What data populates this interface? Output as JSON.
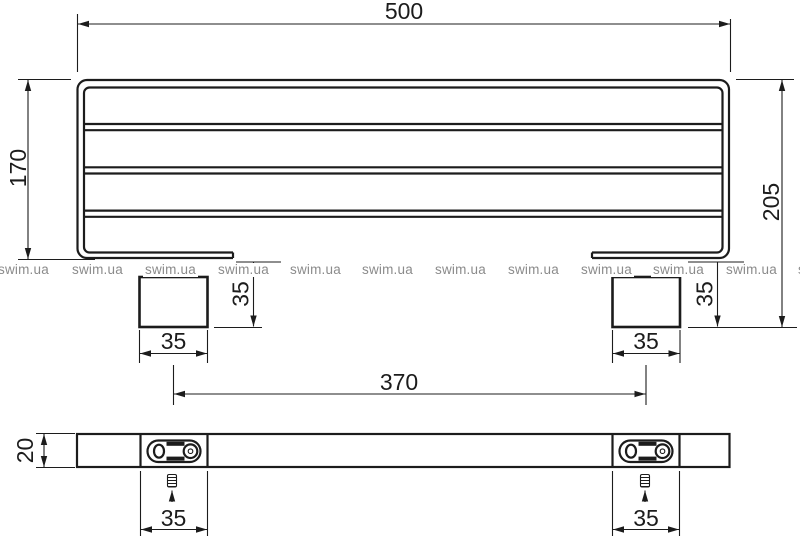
{
  "front_view": {
    "overall_width": "500",
    "frame_height": "170",
    "overall_height": "205",
    "left_bracket_width": "35",
    "right_bracket_width": "35",
    "left_bracket_height": "35",
    "right_bracket_height": "35",
    "bracket_spacing": "370"
  },
  "bottom_view": {
    "bar_thickness": "20",
    "left_plate_width": "35",
    "right_plate_width": "35"
  },
  "watermark": {
    "text": "swim.ua"
  },
  "colors": {
    "line": "#1c1c1c",
    "watermark": "#8b8b8b",
    "background": "#ffffff"
  }
}
